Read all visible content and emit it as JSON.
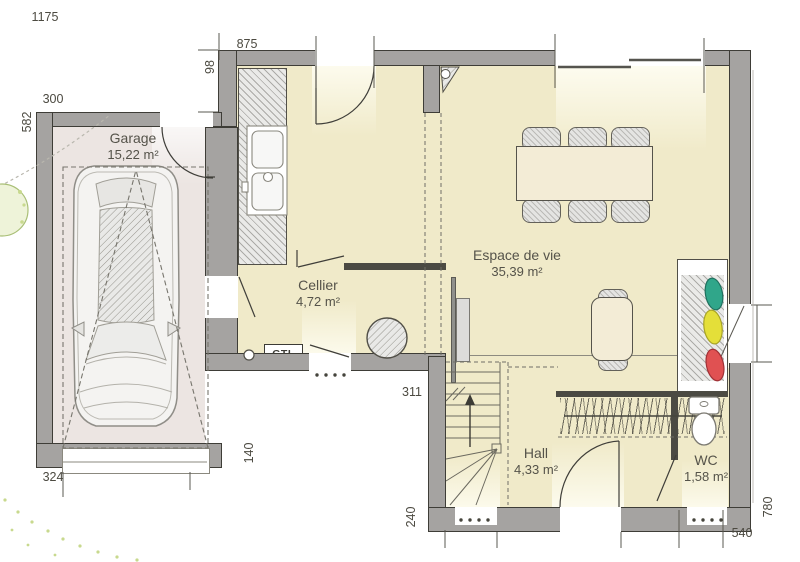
{
  "rooms": {
    "garage": {
      "name": "Garage",
      "area": "15,22 m²"
    },
    "cellier": {
      "name": "Cellier",
      "area": "4,72 m²"
    },
    "living": {
      "name": "Espace de vie",
      "area": "35,39 m²"
    },
    "hall": {
      "name": "Hall",
      "area": "4,33 m²"
    },
    "wc": {
      "name": "WC",
      "area": "1,58 m²"
    }
  },
  "annotations": {
    "gtl": "GTL"
  },
  "dimensions": {
    "overall_width": "1175",
    "front_top": "875",
    "step": "98",
    "garage_width": "300",
    "garage_depth": "582",
    "garage_door": "324",
    "garage_side": "140",
    "cellier_width": "311",
    "stair_side": "240",
    "bottom_right": "540",
    "right_height": "780"
  },
  "colors": {
    "wall": "#a5a3a1",
    "floor": "#f0eac9",
    "garage_floor": "#ece5e2",
    "accent_green": "#30a68a",
    "accent_yellow": "#e4df39",
    "accent_red": "#e05152"
  }
}
